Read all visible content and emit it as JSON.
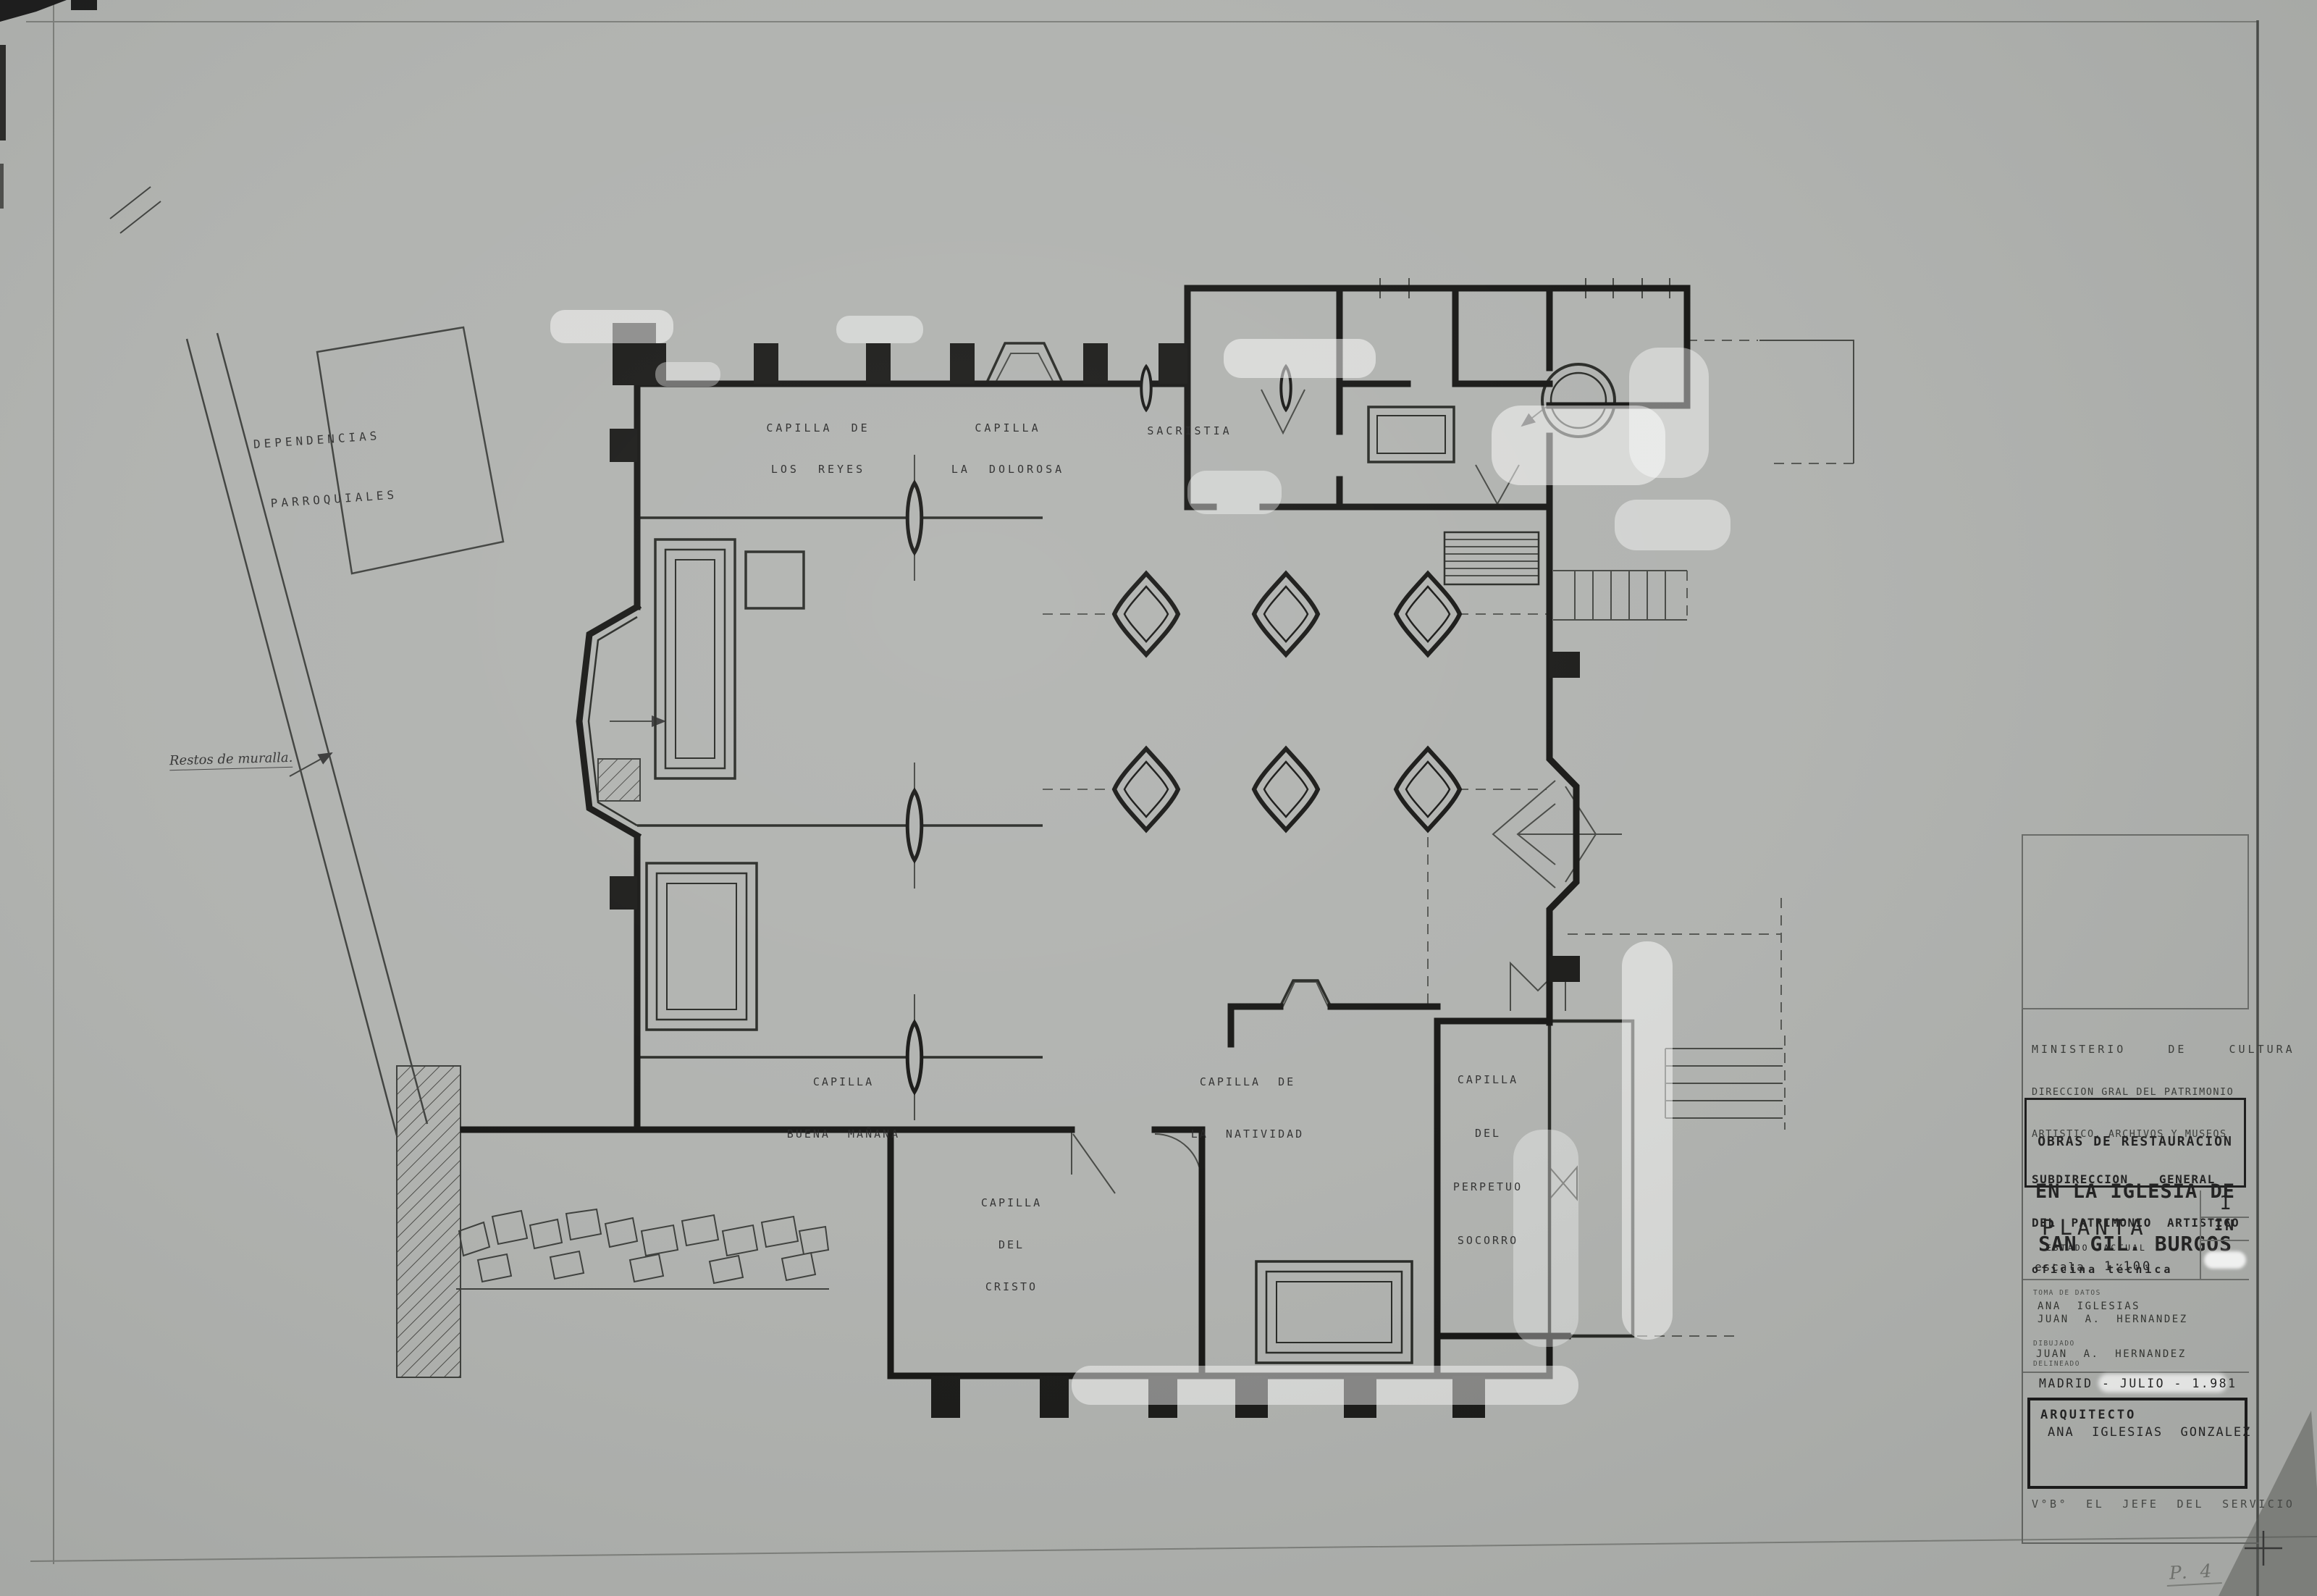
{
  "sheet": {
    "page_number": "P. 4",
    "paper_color": "#b0b2af",
    "line_color": "#1a1a1a"
  },
  "plan": {
    "labels": {
      "capilla_reyes": {
        "line1": "CAPILLA  DE",
        "line2": "LOS  REYES"
      },
      "capilla_dolorosa": {
        "line1": "CAPILLA",
        "line2": "LA  DOLOROSA"
      },
      "sacristia": {
        "line1": "SACRISTIA"
      },
      "capilla_buena_manana": {
        "line1": "CAPILLA",
        "line2": "BUENA  MAÑANA"
      },
      "capilla_natividad": {
        "line1": "CAPILLA  DE",
        "line2": "LA  NATIVIDAD"
      },
      "capilla_perpetuo_socorro": {
        "line1": "CAPILLA",
        "line2": "DEL",
        "line3": "PERPETUO",
        "line4": "SOCORRO"
      },
      "capilla_cristo": {
        "line1": "CAPILLA",
        "line2": "DEL",
        "line3": "CRISTO"
      },
      "dependencias": {
        "line1": "DEPENDENCIAS",
        "line2": "PARROQUIALES"
      },
      "restos_muralla": "Restos de muralla."
    }
  },
  "title_block": {
    "ministry": {
      "line1": "MINISTERIO  DE  CULTURA",
      "line2": "DIRECCION GRAL DEL PATRIMONIO",
      "line3": "ARTISTICO, ARCHIVOS Y MUSEOS",
      "line4": "SUBDIRECCION  GENERAL",
      "line5": "DEL PATRIMONIO ARTISTICO",
      "line6": "oficina técnica"
    },
    "project": {
      "line1": "OBRAS DE RESTAURACION",
      "line2": "EN LA IGLESIA DE",
      "line3": "SAN GIL. BURGOS"
    },
    "drawing": {
      "title": "PLANTA",
      "subtitle": "ESTADO  ACTUAL",
      "scale_label": "escala",
      "scale_value": "1:100",
      "sheet_number": "1",
      "sheet_code": "IN"
    },
    "credits": {
      "toma_label": "TOMA DE DATOS",
      "toma_1": "ANA  IGLESIAS",
      "toma_2": "JUAN  A.  HERNANDEZ",
      "dibujado_label": "DIBUJADO",
      "dibujado_name": "JUAN  A.  HERNANDEZ",
      "delineado_label": "DELINEADO"
    },
    "date_line": "MADRID - JULIO - 1.981",
    "architect": {
      "label": "ARQUITECTO",
      "name": "ANA  IGLESIAS  GONZALEZ"
    },
    "approval": "V°B°  EL  JEFE  DEL  SERVICIO"
  }
}
